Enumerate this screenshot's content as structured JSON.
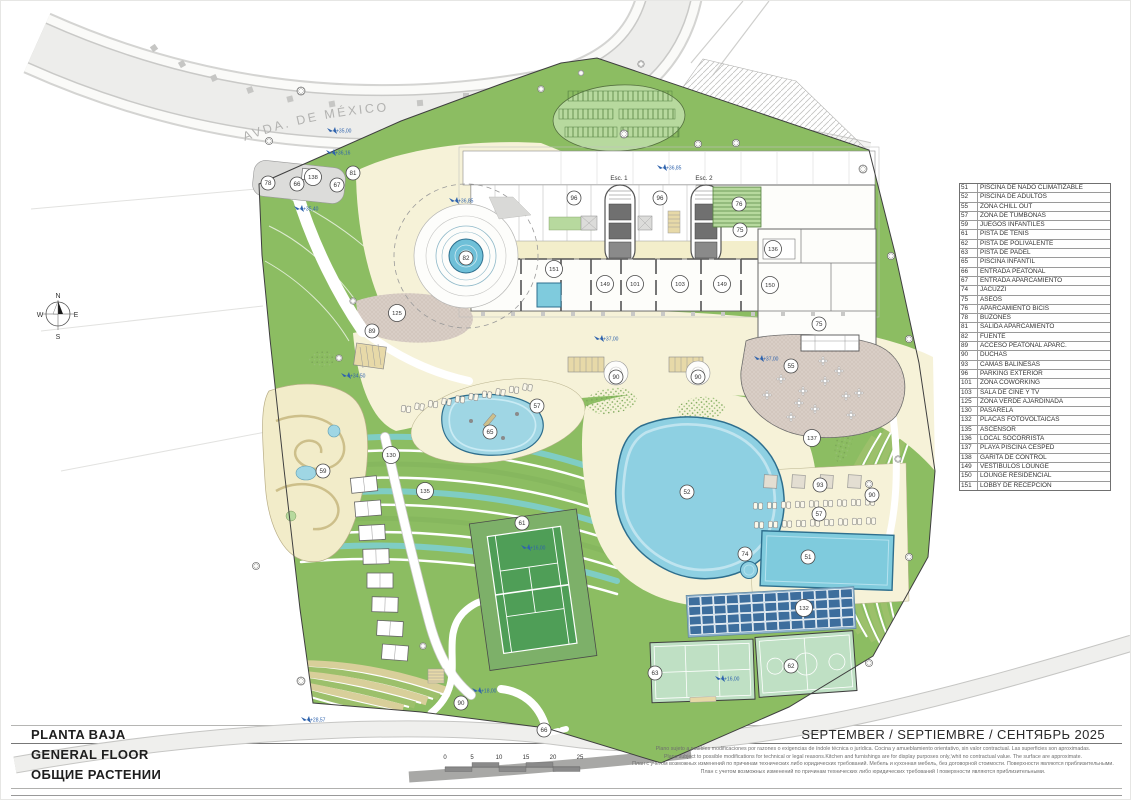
{
  "sheet": {
    "title_es": "PLANTA BAJA",
    "title_en": "GENERAL FLOOR",
    "title_ru": "ОБЩИЕ РАСТЕНИИ",
    "date_line": "SEPTEMBER / SEPTIEMBRE / СЕНТЯБРЬ 2025"
  },
  "street": {
    "label": "AVDA. DE MÉXICO"
  },
  "compass": {
    "n": "N",
    "s": "S",
    "e": "E",
    "w": "W"
  },
  "legend": {
    "items": [
      {
        "n": "51",
        "label": "PISCINA DE NADO CLIMATIZABLE"
      },
      {
        "n": "52",
        "label": "PISCINA DE ADULTOS"
      },
      {
        "n": "55",
        "label": "ZONA CHILL OUT"
      },
      {
        "n": "57",
        "label": "ZONA DE TUMBONAS"
      },
      {
        "n": "59",
        "label": "JUEGOS INFANTILES"
      },
      {
        "n": "61",
        "label": "PISTA DE TENIS"
      },
      {
        "n": "62",
        "label": "PISTA DE POLIVALENTE"
      },
      {
        "n": "63",
        "label": "PISTA DE PADEL"
      },
      {
        "n": "65",
        "label": "PISCINA INFANTIL"
      },
      {
        "n": "66",
        "label": "ENTRADA PEATONAL"
      },
      {
        "n": "67",
        "label": "ENTRADA APARCAMIENTO"
      },
      {
        "n": "74",
        "label": "JACUZZI"
      },
      {
        "n": "75",
        "label": "ASEOS"
      },
      {
        "n": "76",
        "label": "APARCAMIENTO BICIS"
      },
      {
        "n": "78",
        "label": "BUZONES"
      },
      {
        "n": "81",
        "label": "SALIDA APARCAMIENTO"
      },
      {
        "n": "82",
        "label": "FUENTE"
      },
      {
        "n": "89",
        "label": "ACCESO PEATONAL APARC."
      },
      {
        "n": "90",
        "label": "DUCHAS"
      },
      {
        "n": "93",
        "label": "CAMAS BALINESAS"
      },
      {
        "n": "96",
        "label": "PARKING EXTERIOR"
      },
      {
        "n": "101",
        "label": "ZONA COWORKING"
      },
      {
        "n": "103",
        "label": "SALA DE CINE Y TV"
      },
      {
        "n": "125",
        "label": "ZONA VERDE AJARDINADA"
      },
      {
        "n": "130",
        "label": "PASARELA"
      },
      {
        "n": "132",
        "label": "PLACAS FOTOVOLTAICAS"
      },
      {
        "n": "135",
        "label": "ASCENSOR"
      },
      {
        "n": "136",
        "label": "LOCAL SOCORRISTA"
      },
      {
        "n": "137",
        "label": "PLAYA PISCINA CESPED"
      },
      {
        "n": "138",
        "label": "GARITA DE CONTROL"
      },
      {
        "n": "149",
        "label": "VESTÍBULOS LOUNGE"
      },
      {
        "n": "150",
        "label": "LOUNGE RESIDENCIAL"
      },
      {
        "n": "151",
        "label": "LOBBY DE RECEPCIÓN"
      }
    ]
  },
  "plan": {
    "esc1": "Esc. 1",
    "esc2": "Esc. 2",
    "markers": [
      {
        "n": "78",
        "x": 267,
        "y": 182
      },
      {
        "n": "66",
        "x": 296,
        "y": 183
      },
      {
        "n": "138",
        "x": 312,
        "y": 176
      },
      {
        "n": "67",
        "x": 336,
        "y": 184
      },
      {
        "n": "81",
        "x": 352,
        "y": 172
      },
      {
        "n": "96",
        "x": 573,
        "y": 197
      },
      {
        "n": "96",
        "x": 659,
        "y": 197
      },
      {
        "n": "76",
        "x": 738,
        "y": 203
      },
      {
        "n": "75",
        "x": 739,
        "y": 229
      },
      {
        "n": "136",
        "x": 772,
        "y": 248
      },
      {
        "n": "151",
        "x": 553,
        "y": 268
      },
      {
        "n": "149",
        "x": 604,
        "y": 283
      },
      {
        "n": "101",
        "x": 634,
        "y": 283
      },
      {
        "n": "103",
        "x": 679,
        "y": 283
      },
      {
        "n": "149",
        "x": 721,
        "y": 283
      },
      {
        "n": "150",
        "x": 769,
        "y": 284
      },
      {
        "n": "82",
        "x": 465,
        "y": 257
      },
      {
        "n": "125",
        "x": 396,
        "y": 312
      },
      {
        "n": "89",
        "x": 371,
        "y": 330
      },
      {
        "n": "75",
        "x": 818,
        "y": 323
      },
      {
        "n": "55",
        "x": 790,
        "y": 365
      },
      {
        "n": "137",
        "x": 811,
        "y": 437
      },
      {
        "n": "90",
        "x": 615,
        "y": 376
      },
      {
        "n": "90",
        "x": 697,
        "y": 376
      },
      {
        "n": "57",
        "x": 536,
        "y": 405
      },
      {
        "n": "65",
        "x": 489,
        "y": 431
      },
      {
        "n": "59",
        "x": 322,
        "y": 470
      },
      {
        "n": "130",
        "x": 390,
        "y": 454
      },
      {
        "n": "135",
        "x": 424,
        "y": 490
      },
      {
        "n": "52",
        "x": 686,
        "y": 491
      },
      {
        "n": "61",
        "x": 521,
        "y": 522
      },
      {
        "n": "74",
        "x": 744,
        "y": 553
      },
      {
        "n": "51",
        "x": 807,
        "y": 556
      },
      {
        "n": "93",
        "x": 819,
        "y": 484
      },
      {
        "n": "90",
        "x": 871,
        "y": 494
      },
      {
        "n": "57",
        "x": 818,
        "y": 513
      },
      {
        "n": "132",
        "x": 803,
        "y": 607
      },
      {
        "n": "63",
        "x": 654,
        "y": 672
      },
      {
        "n": "62",
        "x": 790,
        "y": 665
      },
      {
        "n": "90",
        "x": 460,
        "y": 702
      },
      {
        "n": "66",
        "x": 543,
        "y": 729
      }
    ],
    "elevations": [
      {
        "v": "+35,00",
        "x": 333,
        "y": 130
      },
      {
        "v": "+36,16",
        "x": 332,
        "y": 152
      },
      {
        "v": "+35,40",
        "x": 300,
        "y": 208
      },
      {
        "v": "+36,85",
        "x": 455,
        "y": 200
      },
      {
        "v": "+36,85",
        "x": 663,
        "y": 167
      },
      {
        "v": "+37,00",
        "x": 600,
        "y": 338
      },
      {
        "v": "+37,00",
        "x": 760,
        "y": 358
      },
      {
        "v": "+34,50",
        "x": 347,
        "y": 375
      },
      {
        "v": "+16,00",
        "x": 527,
        "y": 547
      },
      {
        "v": "+16,00",
        "x": 721,
        "y": 678
      },
      {
        "v": "+18,00",
        "x": 478,
        "y": 690
      },
      {
        "v": "+28,57",
        "x": 307,
        "y": 719
      }
    ]
  },
  "scalebar": {
    "labels": [
      "0",
      "5",
      "10",
      "15",
      "20",
      "25"
    ]
  },
  "disclaimer": {
    "lines": [
      "Plano sujeto a posibles modificaciones por razones o exigencias de índole técnica o jurídica. Cocina y amueblamiento orientativo, sin valor contractual. Las superficies son aproximadas.",
      "Plans subject to possible modifications for technical or legal reasons.Kitchen and furnishings are for display purposes only,'whit no contractual value. The surface are approximate.",
      "План с учетом возможных изменений по причинам технических либо юридических требований. Мебель и кухонная мебель, без договорной стоимости. Поверхности являются приблизительными.",
      "План с учетом возможных изменений по причинам технических либо юридических требований I поверхности являются приблизительными."
    ]
  },
  "palette": {
    "grass": "#8cbd62",
    "water": "#7fcbdd",
    "path_cream": "#f6f2d8",
    "plaza_taupe": "#d9cec6",
    "terrace_teal": "#7fcdc4",
    "solar_blue": "#3d6e9d",
    "elevation_blue": "#2f63ad"
  }
}
